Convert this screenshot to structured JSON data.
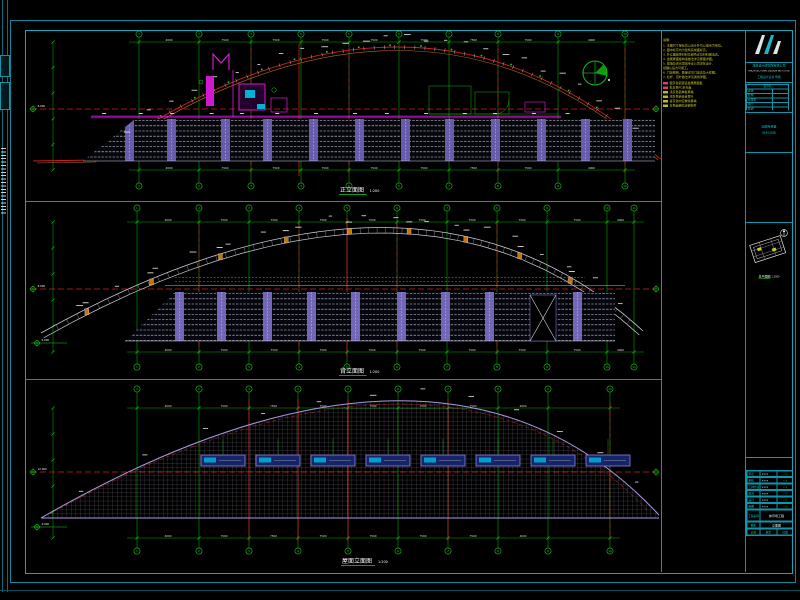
{
  "palette": {
    "background": "#000000",
    "frame_cyan": "#0d96ac",
    "green": "#00b400",
    "bright_green": "#19d119",
    "red": "#cf1f1f",
    "orange": "#b9641c",
    "magenta": "#e01ee0",
    "purple": "#6f63b8",
    "purple2": "#7b6fc4",
    "lavender": "#a89ae0",
    "white": "#e8e8e8",
    "yellow": "#c9c92e",
    "cyan": "#00c8c8",
    "sky_blue": "#15246b",
    "sky_cyan": "#00b4d8",
    "gray": "#8c8c9c"
  },
  "legend": {
    "title": "说明:",
    "notes": [
      "1. 本图尺寸除标高以米计外均以毫米为单位。",
      "2. 图中标高均为建筑完成面标高。",
      "3. 外立面装饰材料及颜色详见材料做法表。",
      "4. 金属屋面板构造做法详见屋面详图。",
      "5. 幕墙及采光顶由专业公司深化设计,",
      "    经确认后方可施工。",
      "6. 门窗规格、数量详见门窗表及大样图。",
      "7. 栏杆、百叶做法详见通用详图。"
    ],
    "items": [
      {
        "color": "#d04070",
        "text": "银灰色铝镁锰金属屋面板"
      },
      {
        "color": "#d04070",
        "text": "乳白色PC采光板"
      },
      {
        "color": "#b8b832",
        "text": "浅灰色铝单板幕墙"
      },
      {
        "color": "#b8b832",
        "text": "深灰色铝合金百叶"
      },
      {
        "color": "#b8b832",
        "text": "蓝灰色中空玻璃幕墙"
      },
      {
        "color": "#b8b832",
        "text": "白色氟碳喷涂钢构件"
      }
    ]
  },
  "panels": [
    {
      "caption": "正立面图",
      "scale": "1:200",
      "grid_labels": [
        "1",
        "2",
        "3",
        "4",
        "5",
        "6",
        "7",
        "8",
        "9",
        "10"
      ],
      "dim_values": [
        "4000",
        "7500",
        "7500",
        "7500",
        "7500",
        "7500",
        "7500",
        "7500",
        "4000"
      ],
      "level_value": "8.000",
      "level_value_2": "0.000"
    },
    {
      "caption": "背立面图",
      "scale": "1:200",
      "grid_labels": [
        "1",
        "2",
        "3",
        "4",
        "5",
        "6",
        "7",
        "8",
        "9",
        "10",
        "11"
      ],
      "dim_values": [
        "4000",
        "7500",
        "7500",
        "7500",
        "7500",
        "7500",
        "7500",
        "7500",
        "7500",
        "4000"
      ],
      "level_value": "8.000",
      "level_value_2": "0.000"
    },
    {
      "caption": "屋面立面图",
      "scale": "1:200",
      "grid_labels": [
        "1",
        "2",
        "3",
        "4",
        "5",
        "6",
        "7",
        "8",
        "9",
        "10"
      ],
      "dim_values": [
        "4000",
        "7500",
        "7500",
        "7500",
        "7500",
        "7500",
        "7500",
        "4000"
      ],
      "level_value": "12.000",
      "level_value_2": "0.000"
    }
  ],
  "key_plan": {
    "caption": "总平面图",
    "scale": "1:2000"
  },
  "title_block": {
    "company": "建筑设计研究院有限公司",
    "company_en": "ARCHITECTURAL DESIGN INSTITUTE",
    "cert": "工程设计证书 甲级",
    "cosign_header": "会签栏",
    "cosign_rows": [
      "建筑",
      "结构",
      "给排水",
      "电气",
      "暖通",
      "总图"
    ],
    "stamp": "出图专用章",
    "stamp_sub": "(技术专用章)",
    "sign_rows": [
      {
        "label": "审定",
        "name": "×××"
      },
      {
        "label": "审核",
        "name": "×××"
      },
      {
        "label": "工种负责",
        "name": "×××"
      },
      {
        "label": "校对",
        "name": "×××"
      },
      {
        "label": "设计",
        "name": "×××"
      },
      {
        "label": "制图",
        "name": "×××"
      }
    ],
    "project_label": "工程名称",
    "project_name": "体育场工程",
    "drawing_label": "图名",
    "drawing_name": "立面图",
    "scale_label": "比例",
    "scale": "1:200",
    "no_label": "图号",
    "date_label": "日期"
  }
}
